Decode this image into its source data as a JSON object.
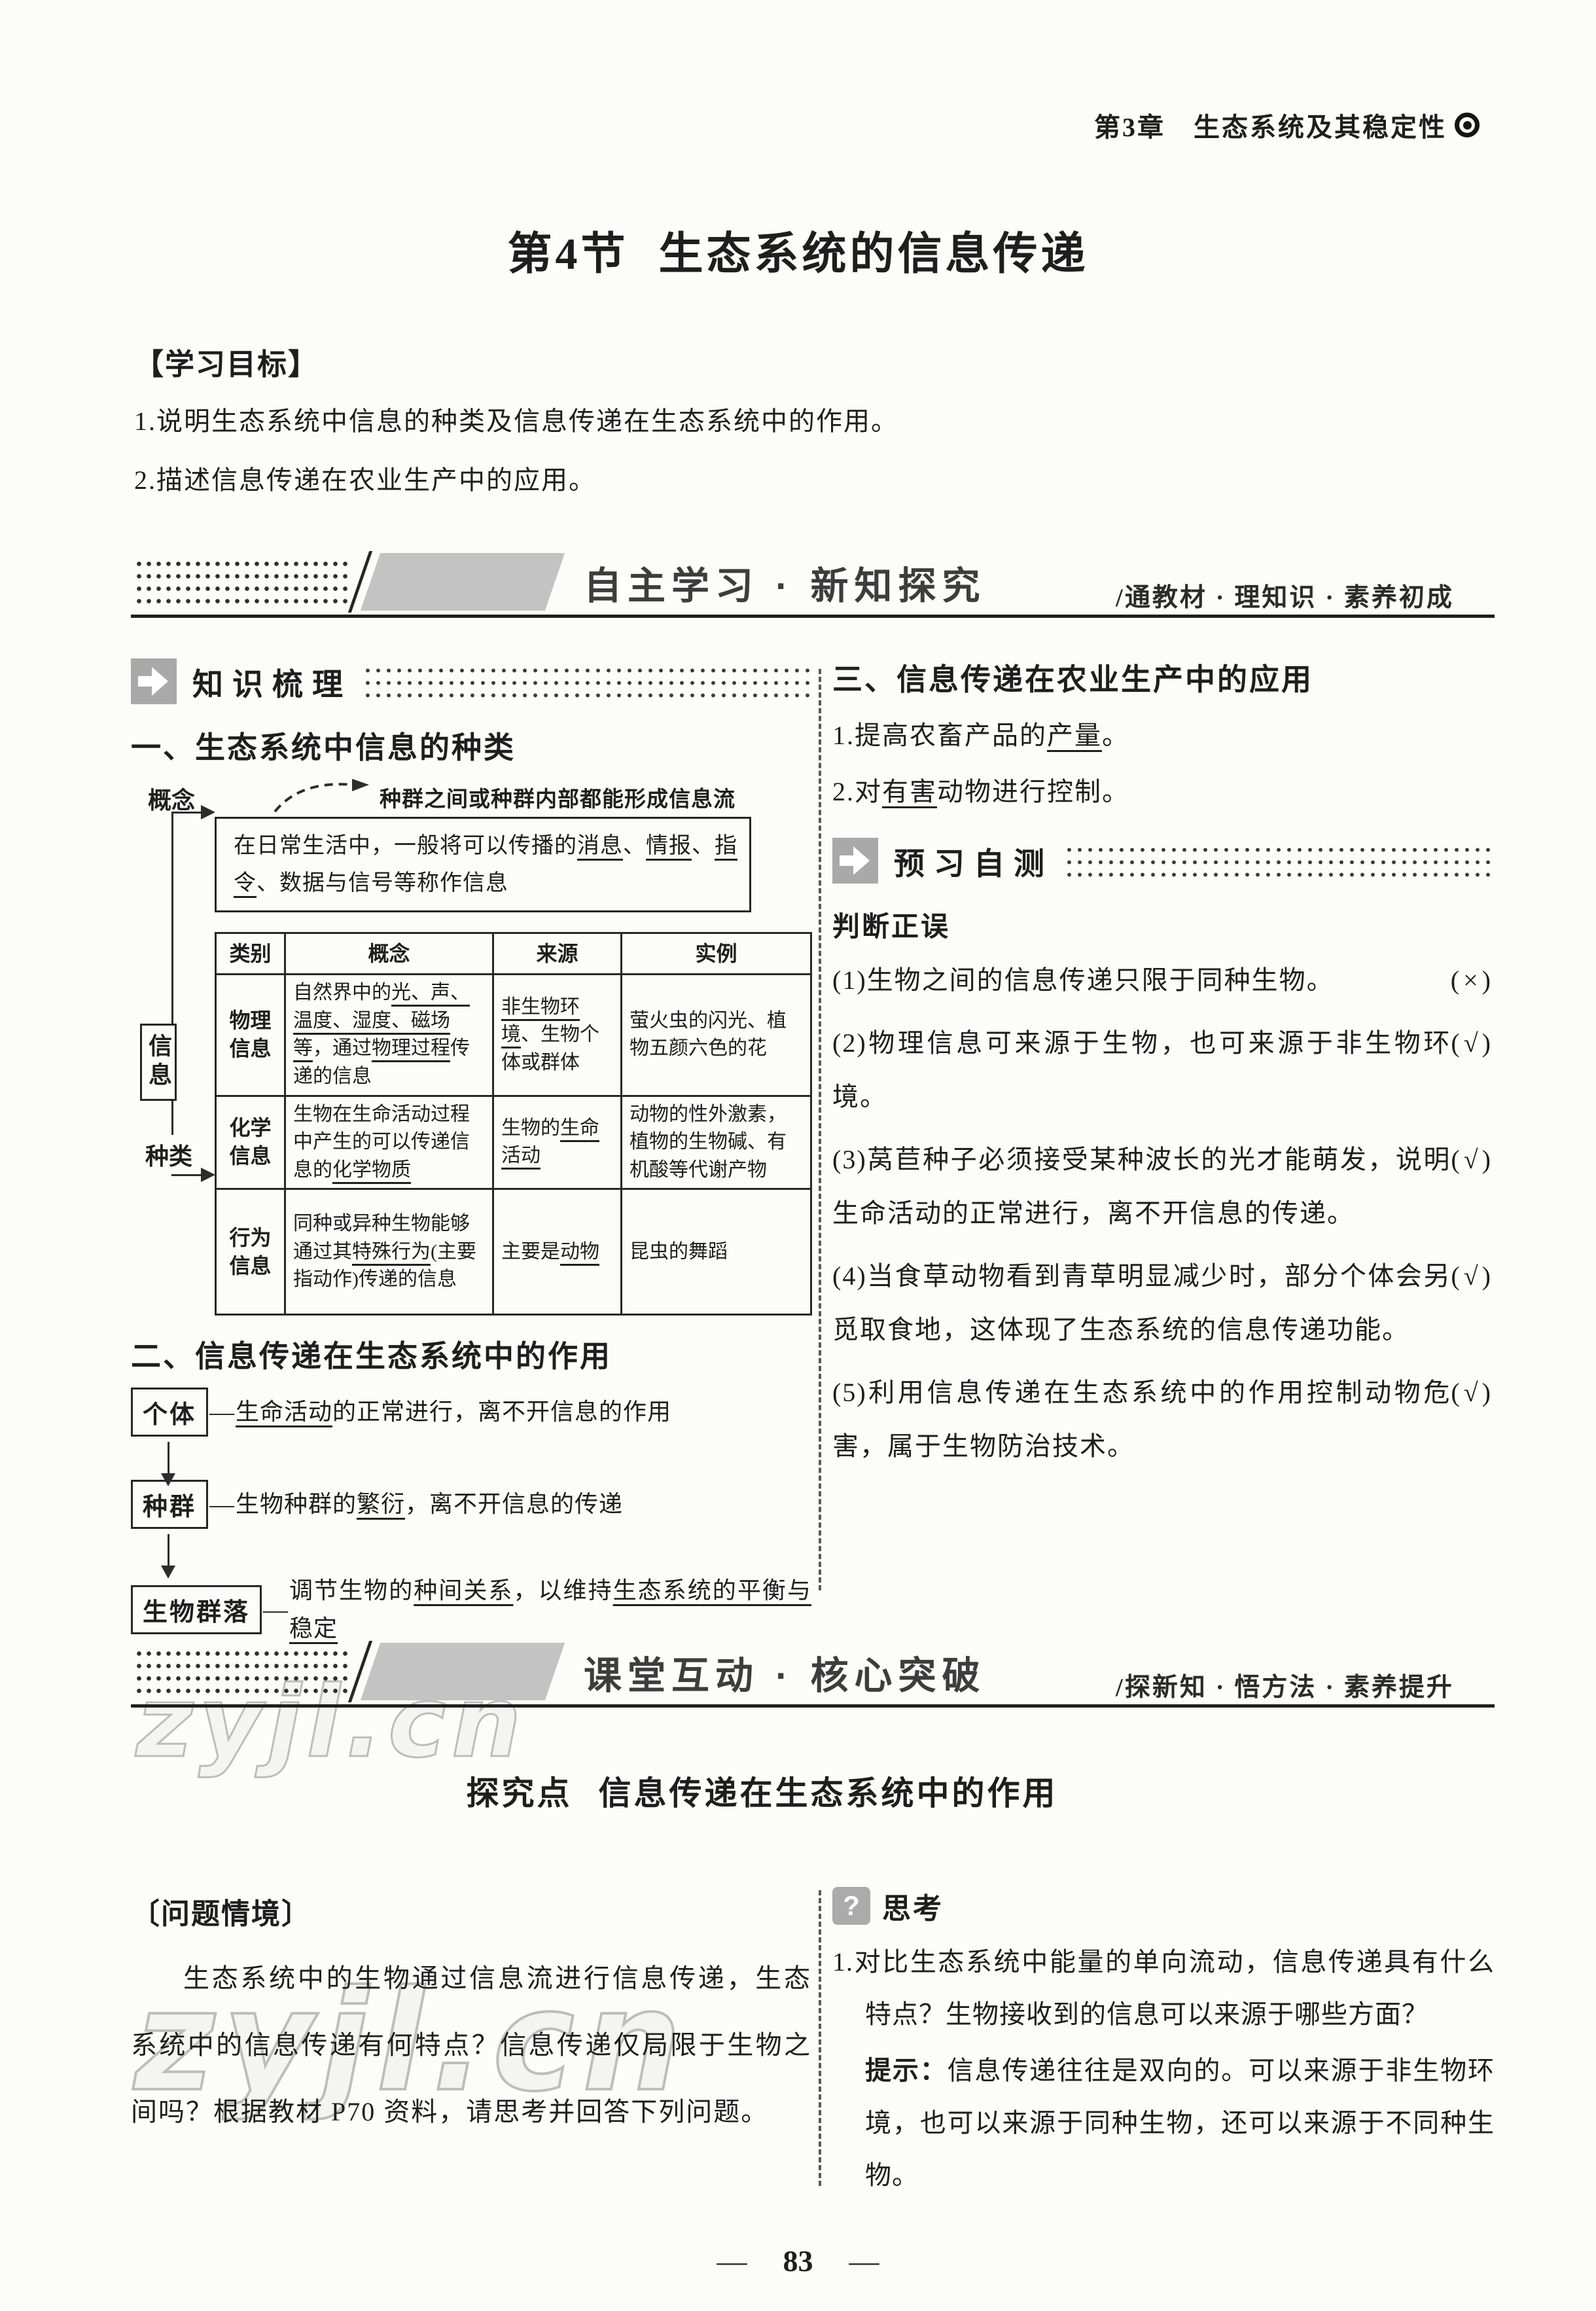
{
  "colors": {
    "ink": "#1e1e1e",
    "banner_shape": "#c3c3c3",
    "icon_gray": "#a9a9a9",
    "watermark_stroke": "#bdbdbd"
  },
  "icons": {
    "chapter_bullet": "ring-dot",
    "tag_arrow": "arrow-right",
    "think": "question-mark",
    "think_glyph": "?"
  },
  "page": {
    "chapter": "第3章　生态系统及其稳定性",
    "title_prefix": "第4节",
    "title_main": "生态系统的信息传递",
    "watermark": "zyjl.cn",
    "page_number": "83",
    "page_dash": "—"
  },
  "goals": {
    "heading": "【学习目标】",
    "items": [
      "1.说明生态系统中信息的种类及信息传递在生态系统中的作用。",
      "2.描述信息传递在农业生产中的应用。"
    ]
  },
  "banner1": {
    "title": "自主学习 · 新知探究",
    "subtitle": "/通教材 · 理知识 · 素养初成"
  },
  "banner2": {
    "title": "课堂互动 · 核心突破",
    "subtitle": "/探新知 · 悟方法 · 素养提升"
  },
  "knowledge": {
    "tag_label": "知识梳理",
    "sec1_heading": "一、生态系统中信息的种类",
    "annotation": "种群之间或种群内部都能形成信息流",
    "concept_label": "概念",
    "type_label": "种类",
    "info_box": "信息",
    "concept_rich": [
      [
        "在日常生活中，一般将可以传播的",
        0
      ],
      [
        "消息",
        1
      ],
      [
        "、",
        0
      ],
      [
        "情报",
        1
      ],
      [
        "、",
        0
      ],
      [
        "指令",
        1
      ],
      [
        "、数据与信号等称作信息",
        0
      ]
    ],
    "table": {
      "headers": [
        "类别",
        "概念",
        "来源",
        "实例"
      ],
      "rows": [
        {
          "type": "物理信息",
          "concept": [
            [
              "自然界中的",
              0
            ],
            [
              "光、声、温度、湿度、磁场等",
              1
            ],
            [
              "，通过",
              0
            ],
            [
              "物理过程",
              1
            ],
            [
              "传递的信息",
              0
            ]
          ],
          "source": [
            [
              "非生物环境",
              1
            ],
            [
              "、生物个体或群体",
              0
            ]
          ],
          "example": [
            [
              "萤火虫的闪光、植物五颜六色的花",
              0
            ]
          ]
        },
        {
          "type": "化学信息",
          "concept": [
            [
              "生物在生命活动过程中产生的可以传递信息的",
              0
            ],
            [
              "化学物质",
              1
            ]
          ],
          "source": [
            [
              "生物的",
              0
            ],
            [
              "生命活动",
              1
            ]
          ],
          "example": [
            [
              "动物的性外激素，植物的生物碱、有机酸等代谢产物",
              0
            ]
          ]
        },
        {
          "type": "行为信息",
          "concept": [
            [
              "同种或异种生物能够通过其",
              0
            ],
            [
              "特殊行为",
              1
            ],
            [
              "(主要指动作)传递的信息",
              0
            ]
          ],
          "source": [
            [
              "主要是",
              0
            ],
            [
              "动物",
              1
            ]
          ],
          "example": [
            [
              "昆虫的舞蹈",
              0
            ]
          ]
        }
      ]
    },
    "sec2_heading": "二、信息传递在生态系统中的作用",
    "flow": [
      {
        "box": "个体",
        "dash": "—",
        "desc": [
          [
            "生命活动",
            1
          ],
          [
            "的正常进行，离不开信息的作用",
            0
          ]
        ]
      },
      {
        "box": "种群",
        "dash": "—",
        "desc": [
          [
            "生物种群的",
            0
          ],
          [
            "繁衍",
            1
          ],
          [
            "，离不开信息的传递",
            0
          ]
        ]
      },
      {
        "box": "生物群落",
        "dash": "—",
        "desc": [
          [
            "调节生物的",
            0
          ],
          [
            "种间关系",
            1
          ],
          [
            "，以维持",
            0
          ],
          [
            "生态系统的平衡与稳定",
            1
          ]
        ]
      }
    ]
  },
  "application": {
    "heading": "三、信息传递在农业生产中的应用",
    "items": [
      [
        [
          "1.提高农畜产品的",
          0
        ],
        [
          "产量",
          1
        ],
        [
          "。",
          0
        ]
      ],
      [
        [
          "2.对",
          0
        ],
        [
          "有害",
          1
        ],
        [
          "动物进行控制。",
          0
        ]
      ]
    ]
  },
  "pretest": {
    "tag_label": "预习自测",
    "subheading": "判断正误",
    "judgments": [
      {
        "text": "(1)生物之间的信息传递只限于同种生物。",
        "answer": "(×)"
      },
      {
        "text": "(2)物理信息可来源于生物，也可来源于非生物环境。",
        "answer": "(√)"
      },
      {
        "text": "(3)莴苣种子必须接受某种波长的光才能萌发，说明生命活动的正常进行，离不开信息的传递。",
        "answer": "(√)"
      },
      {
        "text": "(4)当食草动物看到青草明显减少时，部分个体会另觅取食地，这体现了生态系统的信息传递功能。",
        "answer": "(√)"
      },
      {
        "text": "(5)利用信息传递在生态系统中的作用控制动物危害，属于生物防治技术。",
        "answer": "(√)"
      }
    ]
  },
  "explore": {
    "heading_prefix": "探究点",
    "heading_main": "信息传递在生态系统中的作用",
    "situation_label": "〔问题情境〕",
    "situation_text": "生态系统中的生物通过信息流进行信息传递，生态系统中的信息传递有何特点？信息传递仅局限于生物之间吗？根据教材 P70 资料，请思考并回答下列问题。",
    "think_label": "思考",
    "think_q1": "1.对比生态系统中能量的单向流动，信息传递具有什么特点？生物接收到的信息可以来源于哪些方面？",
    "hint_label": "提示：",
    "hint_text": "信息传递往往是双向的。可以来源于非生物环境，也可以来源于同种生物，还可以来源于不同种生物。"
  }
}
